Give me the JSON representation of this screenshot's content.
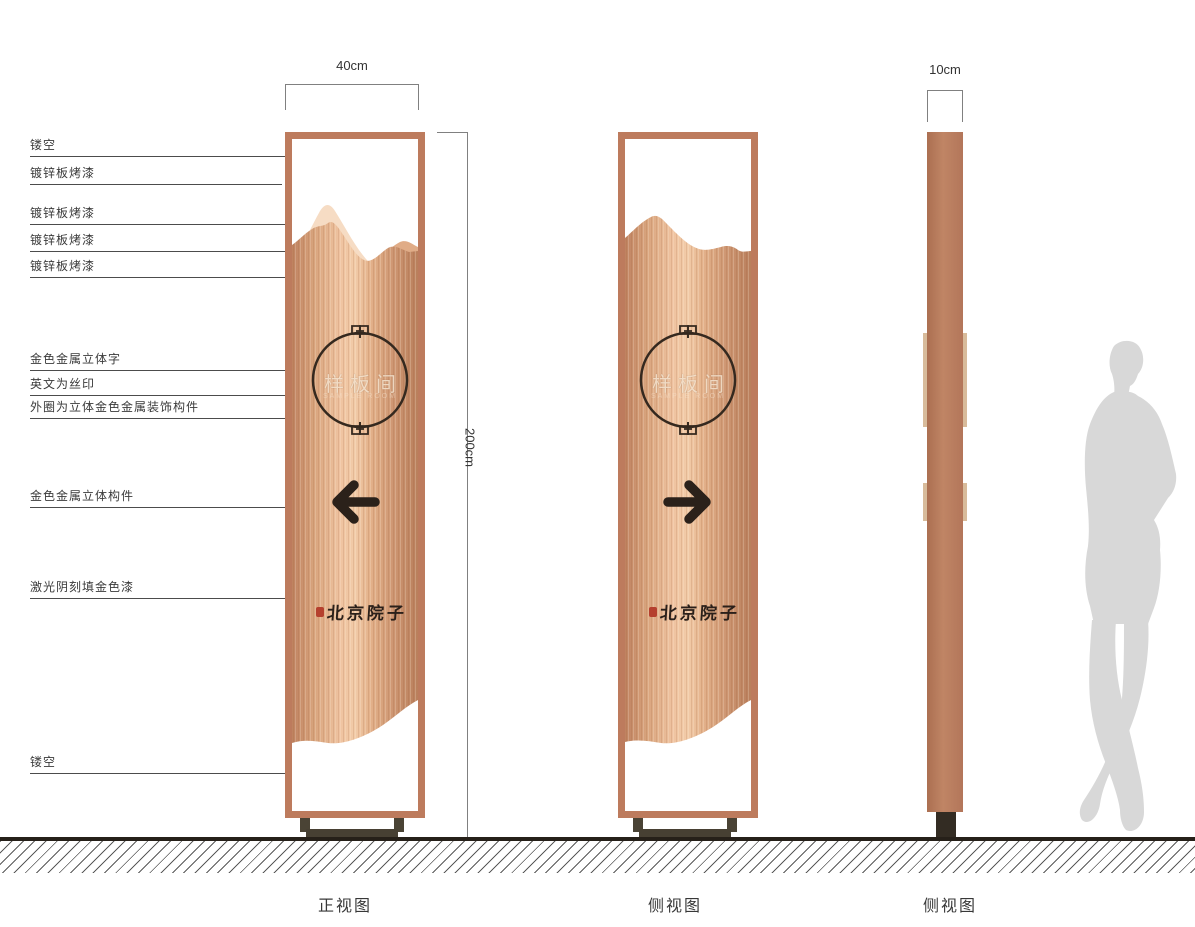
{
  "callouts": [
    "镂空",
    "镀锌板烤漆",
    "镀锌板烤漆",
    "镀锌板烤漆",
    "镀锌板烤漆",
    "金色金属立体字",
    "英文为丝印",
    "外圈为立体金色金属装饰构件",
    "金色金属立体构件",
    "激光阴刻填金色漆",
    "镂空"
  ],
  "dimensions": {
    "front_width": "40cm",
    "height": "200cm",
    "side_width": "10cm"
  },
  "sign": {
    "circle_text": "样板间",
    "circle_subtext": "SAMPLE ROOM",
    "brand": "北京院子"
  },
  "captions": {
    "front": "正视图",
    "side1": "侧视图",
    "side2": "侧视图"
  },
  "colors": {
    "frame": "#bd7b5d",
    "copper_light": "#f2cba8",
    "copper_dark": "#b97f5c",
    "mountain_back": "#f6dcc4",
    "mountain_mid": "#eebf9f",
    "arrow": "#2b211a",
    "base": "#4a4335",
    "seal_red": "#b5402e",
    "silhouette": "#d8d8d8",
    "ground": "#262019"
  }
}
